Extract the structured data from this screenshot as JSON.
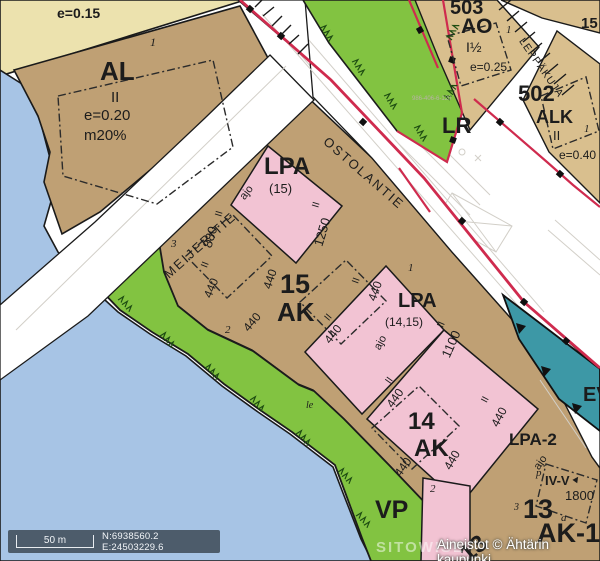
{
  "colors": {
    "water": "#a7c4e5",
    "sand_yellow": "#ece2ae",
    "block_brown": "#bfa074",
    "block_tan": "#d9bf8e",
    "parking_pink": "#f2c3d3",
    "green": "#82c341",
    "teal_ev": "#3d98a6",
    "boundary_red": "#cf2b4e",
    "road_white": "#ffffff",
    "statusbar_bg": "#4d5c6b"
  },
  "statusbar": {
    "scale_label": "50 m",
    "coordinates": "N:6938560.2 E:24503229.6"
  },
  "watermark": "SITOWISE",
  "attribution": "Aineistot © Ähtärin kaupunki",
  "labels": [
    {
      "id": "yellow-efficiency",
      "text": "e=0.15"
    },
    {
      "id": "al-code",
      "text": "AL"
    },
    {
      "id": "al-floors",
      "text": "II"
    },
    {
      "id": "al-efficiency",
      "text": "e=0.20"
    },
    {
      "id": "al-coverage",
      "text": "m20%"
    },
    {
      "id": "al-parcel",
      "text": "1"
    },
    {
      "id": "street-meijeritie",
      "text": "MEIJERITIE"
    },
    {
      "id": "street-ostolantie",
      "text": "OSTOLANTIE"
    },
    {
      "id": "street-leppakuja",
      "text": "LEPPÄKUJA"
    },
    {
      "id": "block-503",
      "text": "503"
    },
    {
      "id": "block-503-code",
      "text": "AO"
    },
    {
      "id": "block-503-floors",
      "text": "I½"
    },
    {
      "id": "block-503-efficiency",
      "text": "e=0.25"
    },
    {
      "id": "block-503-parcel",
      "text": "1"
    },
    {
      "id": "block-15-corner",
      "text": "15"
    },
    {
      "id": "block-502",
      "text": "502"
    },
    {
      "id": "block-502-code",
      "text": "ALK"
    },
    {
      "id": "block-502-floors",
      "text": "II"
    },
    {
      "id": "block-502-efficiency",
      "text": "e=0.40"
    },
    {
      "id": "block-502-parcel",
      "text": "1"
    },
    {
      "id": "lr-code",
      "text": "LR"
    },
    {
      "id": "cadastral-number",
      "text": "986-406-6-120"
    },
    {
      "id": "lpa15-code",
      "text": "LPA"
    },
    {
      "id": "lpa15-sub",
      "text": "(15)"
    },
    {
      "id": "ajo-1",
      "text": "ajo"
    },
    {
      "id": "parcel-3",
      "text": "3"
    },
    {
      "id": "buildright-880",
      "text": "880"
    },
    {
      "id": "floors-880",
      "text": "II"
    },
    {
      "id": "buildright-1250",
      "text": "1250"
    },
    {
      "id": "floors-1250",
      "text": "II"
    },
    {
      "id": "block-15-number",
      "text": "15"
    },
    {
      "id": "block-15-code",
      "text": "AK"
    },
    {
      "id": "buildright-440-a",
      "text": "440"
    },
    {
      "id": "buildright-440-b",
      "text": "440"
    },
    {
      "id": "buildright-440-c",
      "text": "440"
    },
    {
      "id": "buildright-440-d",
      "text": "440"
    },
    {
      "id": "buildright-440-e",
      "text": "440"
    },
    {
      "id": "parcel-2-blk15",
      "text": "2"
    },
    {
      "id": "parcel-1-blk15",
      "text": "1"
    },
    {
      "id": "lpa1415-code",
      "text": "LPA"
    },
    {
      "id": "lpa1415-sub",
      "text": "(14,15)"
    },
    {
      "id": "ajo-2",
      "text": "ajo"
    },
    {
      "id": "buildright-1100",
      "text": "1100"
    },
    {
      "id": "floors-1100",
      "text": "II"
    },
    {
      "id": "buildright-440-f",
      "text": "440"
    },
    {
      "id": "buildright-440-g",
      "text": "440"
    },
    {
      "id": "block-14-number",
      "text": "14"
    },
    {
      "id": "block-14-code",
      "text": "AK"
    },
    {
      "id": "buildright-440-h",
      "text": "440"
    },
    {
      "id": "buildright-440-i",
      "text": "440"
    },
    {
      "id": "parcel-2-blk14",
      "text": "2"
    },
    {
      "id": "lpa2-code",
      "text": "LPA-2"
    },
    {
      "id": "ajo-3",
      "text": "ajo"
    },
    {
      "id": "p-mark",
      "text": "p"
    },
    {
      "id": "floors-iv-v",
      "text": "IV-V"
    },
    {
      "id": "roof-arrow",
      "text": "▲"
    },
    {
      "id": "buildright-1800",
      "text": "1800"
    },
    {
      "id": "parcel-3-blk13",
      "text": "3"
    },
    {
      "id": "block-13-number",
      "text": "13"
    },
    {
      "id": "parcel-a-blk13",
      "text": "a"
    },
    {
      "id": "block-13-code",
      "text": "AK-1"
    },
    {
      "id": "vp-code",
      "text": "VP"
    },
    {
      "id": "ev-code",
      "text": "EV"
    },
    {
      "id": "block-13-rotated",
      "text": "13"
    },
    {
      "id": "le-mark",
      "text": "le"
    },
    {
      "id": "floors-mark-a",
      "text": "II"
    },
    {
      "id": "floors-mark-b",
      "text": "II"
    },
    {
      "id": "floors-mark-c",
      "text": "II"
    },
    {
      "id": "floors-mark-d",
      "text": "II"
    },
    {
      "id": "floors-mark-e",
      "text": "II"
    }
  ]
}
